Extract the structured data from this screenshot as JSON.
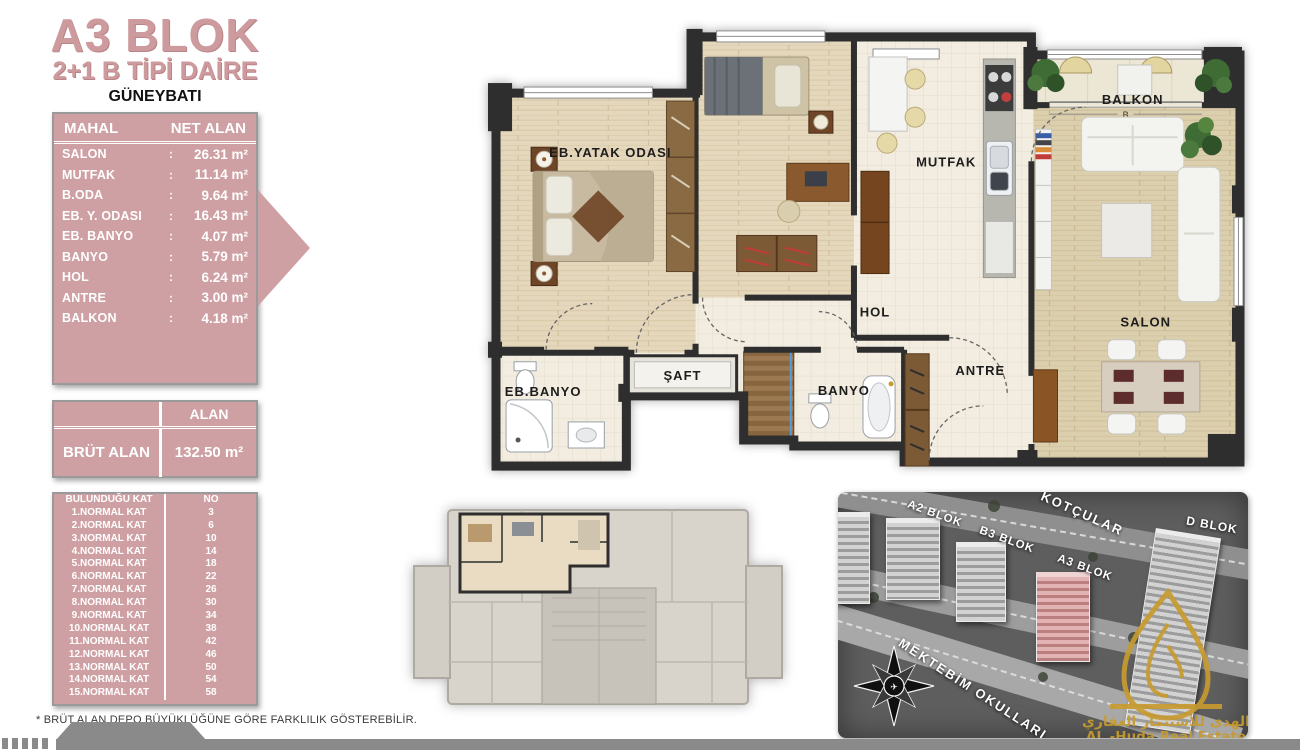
{
  "title": {
    "block": "A3 BLOK",
    "unit_type": "2+1 B TİPİ DAİRE",
    "orientation": "GÜNEYBATI"
  },
  "net_table": {
    "col1": "MAHAL",
    "col2": "NET ALAN",
    "colon": ":",
    "rows": [
      {
        "label": "SALON",
        "value": "26.31 m²"
      },
      {
        "label": "MUTFAK",
        "value": "11.14 m²"
      },
      {
        "label": "B.ODA",
        "value": "9.64 m²"
      },
      {
        "label": "EB. Y. ODASI",
        "value": "16.43 m²"
      },
      {
        "label": "EB. BANYO",
        "value": "4.07 m²"
      },
      {
        "label": "BANYO",
        "value": "5.79 m²"
      },
      {
        "label": "HOL",
        "value": "6.24 m²"
      },
      {
        "label": "ANTRE",
        "value": "3.00 m²"
      },
      {
        "label": "BALKON",
        "value": "4.18 m²"
      }
    ]
  },
  "brut_table": {
    "header": "ALAN",
    "label": "BRÜT ALAN",
    "value": "132.50 m²"
  },
  "floor_table": {
    "col1": "BULUNDUĞU KAT",
    "col2": "NO",
    "rows": [
      {
        "label": "1.NORMAL KAT",
        "no": "3"
      },
      {
        "label": "2.NORMAL KAT",
        "no": "6"
      },
      {
        "label": "3.NORMAL KAT",
        "no": "10"
      },
      {
        "label": "4.NORMAL KAT",
        "no": "14"
      },
      {
        "label": "5.NORMAL KAT",
        "no": "18"
      },
      {
        "label": "6.NORMAL KAT",
        "no": "22"
      },
      {
        "label": "7.NORMAL KAT",
        "no": "26"
      },
      {
        "label": "8.NORMAL KAT",
        "no": "30"
      },
      {
        "label": "9.NORMAL KAT",
        "no": "34"
      },
      {
        "label": "10.NORMAL KAT",
        "no": "38"
      },
      {
        "label": "11.NORMAL KAT",
        "no": "42"
      },
      {
        "label": "12.NORMAL KAT",
        "no": "46"
      },
      {
        "label": "13.NORMAL KAT",
        "no": "50"
      },
      {
        "label": "14.NORMAL KAT",
        "no": "54"
      },
      {
        "label": "15.NORMAL KAT",
        "no": "58"
      }
    ]
  },
  "footnote": "* BRÜT ALAN DEPO BÜYÜKLÜĞÜNE GÖRE FARKLILIK GÖSTEREBİLİR.",
  "plan": {
    "rooms": {
      "eb_yatak": "EB.YATAK ODASI",
      "mutfak": "MUTFAK",
      "balkon": "BALKON",
      "salon": "SALON",
      "hol": "HOL",
      "saft": "ŞAFT",
      "eb_banyo": "EB.BANYO",
      "banyo": "BANYO",
      "antre": "ANTRE"
    },
    "dim_label": "B"
  },
  "map": {
    "labels": {
      "a2": "A2 BLOK",
      "b3": "B3 BLOK",
      "a3": "A3 BLOK",
      "d": "D BLOK",
      "street_top": "KOTÇULAR",
      "street_bottom": "MEKTEBİM OKULLARI"
    }
  },
  "logo": {
    "arabic": "الهدى للاستثمار العقاري",
    "latin": "AL -Huda Real Estate"
  },
  "colors": {
    "table_pink": "#cfa0a3",
    "title_rose": "#cd9a9d",
    "wall": "#2e2e2e",
    "highlight_block": "#d89a9a",
    "logo_gold": "#c79b2f"
  }
}
